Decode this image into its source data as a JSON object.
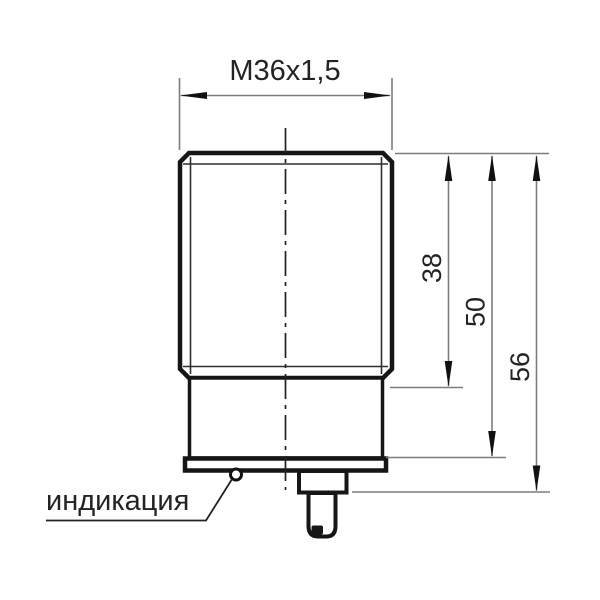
{
  "drawing": {
    "thread_label": "М36х1,5",
    "indicator_label": "индикация",
    "dimensions": {
      "thread_body_length": "38",
      "housing_length": "50",
      "overall_length": "56"
    }
  },
  "colors": {
    "background": "#ffffff",
    "body_outline": "#161616",
    "dimension_lines": "#7d7d7d",
    "arrowheads": "#111111",
    "text": "#232323"
  }
}
